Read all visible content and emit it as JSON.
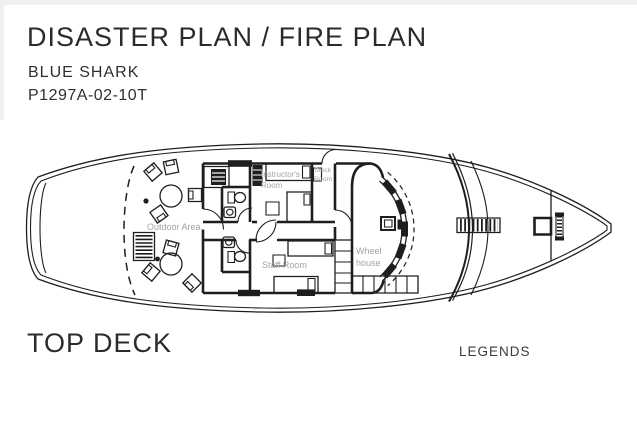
{
  "header": {
    "title": "DISASTER PLAN / FIRE PLAN",
    "vessel_name": "BLUE SHARK",
    "plan_code": "P1297A-02-10T"
  },
  "deck_plan": {
    "deck_name": "TOP DECK",
    "room_labels": {
      "outdoor_area": "Outdoor Area",
      "instructors_room_line1": "Instructor's",
      "instructors_room_line2": "Room",
      "stock_room_line1": "Stock",
      "stock_room_line2": "Room",
      "staff_room": "Staff Room",
      "wheel_house_line1": "Wheel",
      "wheel_house_line2": "house"
    },
    "icons": {
      "round_table": "circle-table-symbol",
      "chair": "chair-symbol",
      "grating_bench": "striped-bench-symbol",
      "bed": "bed-with-pillow-symbol",
      "toilet": "wc-toilet-symbol",
      "sink": "washbasin-symbol",
      "stairs": "stair-grid-symbol",
      "ladder": "deck-ladder-symbol",
      "hatch": "deck-hatch-symbol",
      "windlass": "windlass-symbol",
      "helm_console": "steering-console-symbol"
    }
  },
  "legend": {
    "title": "LEGENDS"
  },
  "colors": {
    "ink": "#1e1e1e",
    "room_label": "#a2a2a2",
    "background": "#ffffff",
    "edge_shadow": "#f0f0f0"
  }
}
